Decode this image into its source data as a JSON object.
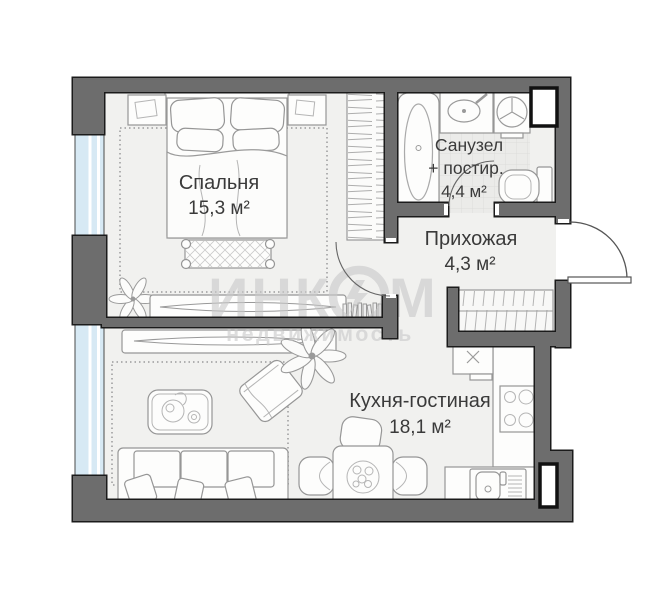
{
  "plan": {
    "watermark": {
      "part1": "ИНК",
      "part2": "М",
      "line2": "недвижимость"
    },
    "rooms": {
      "bedroom": {
        "name": "Спальня",
        "area": "15,3 м²"
      },
      "bathroom": {
        "name": "Санузел",
        "name2": "+ постир.",
        "area": "4,4 м²"
      },
      "hallway": {
        "name": "Прихожая",
        "area": "4,3 м²"
      },
      "kitchen": {
        "name": "Кухня-гостиная",
        "area": "18,1 м²"
      }
    },
    "colors": {
      "wall": "#6d6d6d",
      "wall_outline": "#1b1b1b",
      "window": "#d7e9f4",
      "floor": "#f1f1ef",
      "tile": "#ebebe9",
      "label_text": "#3a3a3a",
      "watermark": "#c9c9c9"
    },
    "icons": [
      "bed-icon",
      "pillow-icon",
      "bench-icon",
      "nightstand-icon",
      "wardrobe-icon",
      "rug-icon",
      "plant-icon",
      "tv-console-icon",
      "books-icon",
      "bathtub-icon",
      "sink-icon",
      "washing-machine-icon",
      "toilet-icon",
      "shaft-icon",
      "closet-icon",
      "fridge-icon",
      "stove-icon",
      "kitchen-sink-icon",
      "counter-icon",
      "dining-table-icon",
      "chair-icon",
      "sofa-icon",
      "coffee-table-icon",
      "ottoman-icon",
      "entrance-door-icon",
      "door-arc-icon",
      "window-icon"
    ]
  }
}
